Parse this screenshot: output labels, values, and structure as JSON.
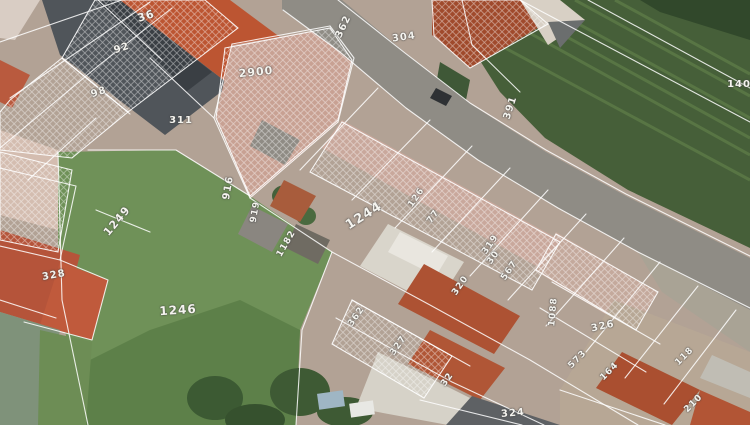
{
  "map": {
    "type": "cadastral-parcel-overlay-on-aerial-photo",
    "overlay_color": "#ffffff",
    "label_color": "#f5f4ef",
    "labels": [
      {
        "text": "36",
        "x": 146,
        "y": 16,
        "rot": -18,
        "size": 11
      },
      {
        "text": "92",
        "x": 122,
        "y": 49,
        "rot": -18,
        "size": 10
      },
      {
        "text": "98",
        "x": 99,
        "y": 93,
        "rot": -18,
        "size": 10
      },
      {
        "text": "311",
        "x": 181,
        "y": 121,
        "rot": 0,
        "size": 10
      },
      {
        "text": "2900",
        "x": 256,
        "y": 72,
        "rot": -6,
        "size": 11
      },
      {
        "text": "362",
        "x": 344,
        "y": 27,
        "rot": -65,
        "size": 10
      },
      {
        "text": "304",
        "x": 404,
        "y": 38,
        "rot": -8,
        "size": 10
      },
      {
        "text": "391",
        "x": 511,
        "y": 108,
        "rot": -72,
        "size": 10
      },
      {
        "text": "140",
        "x": 739,
        "y": 85,
        "rot": 0,
        "size": 10
      },
      {
        "text": "916",
        "x": 229,
        "y": 188,
        "rot": -80,
        "size": 10
      },
      {
        "text": "919",
        "x": 256,
        "y": 212,
        "rot": -80,
        "size": 9
      },
      {
        "text": "1182",
        "x": 287,
        "y": 244,
        "rot": -60,
        "size": 9
      },
      {
        "text": "1244",
        "x": 364,
        "y": 216,
        "rot": -32,
        "size": 13
      },
      {
        "text": "126",
        "x": 417,
        "y": 198,
        "rot": -55,
        "size": 9
      },
      {
        "text": "77",
        "x": 434,
        "y": 217,
        "rot": -55,
        "size": 9
      },
      {
        "text": "319",
        "x": 491,
        "y": 245,
        "rot": -55,
        "size": 9
      },
      {
        "text": "30",
        "x": 494,
        "y": 258,
        "rot": -55,
        "size": 9
      },
      {
        "text": "567",
        "x": 510,
        "y": 271,
        "rot": -55,
        "size": 9
      },
      {
        "text": "320",
        "x": 461,
        "y": 286,
        "rot": -55,
        "size": 9
      },
      {
        "text": "1249",
        "x": 117,
        "y": 221,
        "rot": -50,
        "size": 11
      },
      {
        "text": "328",
        "x": 54,
        "y": 276,
        "rot": -10,
        "size": 10
      },
      {
        "text": "1246",
        "x": 178,
        "y": 310,
        "rot": -4,
        "size": 12
      },
      {
        "text": "362",
        "x": 357,
        "y": 317,
        "rot": -55,
        "size": 9
      },
      {
        "text": "327",
        "x": 399,
        "y": 346,
        "rot": -55,
        "size": 9
      },
      {
        "text": "32",
        "x": 448,
        "y": 380,
        "rot": -55,
        "size": 9
      },
      {
        "text": "324",
        "x": 513,
        "y": 414,
        "rot": -5,
        "size": 10
      },
      {
        "text": "1088",
        "x": 554,
        "y": 312,
        "rot": -85,
        "size": 9
      },
      {
        "text": "326",
        "x": 603,
        "y": 327,
        "rot": -12,
        "size": 10
      },
      {
        "text": "573",
        "x": 578,
        "y": 360,
        "rot": -45,
        "size": 9
      },
      {
        "text": "164",
        "x": 610,
        "y": 372,
        "rot": -45,
        "size": 9
      },
      {
        "text": "118",
        "x": 685,
        "y": 357,
        "rot": -45,
        "size": 9
      },
      {
        "text": "210",
        "x": 694,
        "y": 404,
        "rot": -45,
        "size": 9
      }
    ],
    "overlay": {
      "lines": [
        [
          338,
          0,
          405,
          53,
          470,
          103,
          546,
          150,
          626,
          194,
          750,
          256
        ],
        [
          283,
          10,
          340,
          52,
          406,
          108,
          478,
          160,
          558,
          208,
          638,
          252,
          750,
          308
        ],
        [
          214,
          118,
          250,
          198,
          332,
          252,
          430,
          305,
          530,
          360,
          638,
          425
        ],
        [
          88,
          150,
          176,
          150,
          250,
          196
        ],
        [
          58,
          152,
          62,
          300,
          88,
          425
        ],
        [
          332,
          252,
          302,
          330,
          296,
          425
        ],
        [
          0,
          42,
          122,
          0
        ],
        [
          10,
          98,
          150,
          2
        ],
        [
          0,
          148,
          98,
          66,
          172,
          8
        ],
        [
          62,
          58,
          130,
          114
        ],
        [
          98,
          0,
          162,
          60
        ],
        [
          28,
          180,
          96,
          118
        ],
        [
          150,
          58,
          214,
          118
        ],
        [
          232,
          44,
          214,
          118
        ],
        [
          232,
          44,
          330,
          26
        ],
        [
          330,
          26,
          354,
          58,
          338,
          122
        ],
        [
          338,
          122,
          250,
          198
        ],
        [
          378,
          88,
          300,
          170
        ],
        [
          430,
          120,
          352,
          200
        ],
        [
          472,
          146,
          395,
          228
        ],
        [
          510,
          168,
          432,
          252
        ],
        [
          548,
          190,
          470,
          276
        ],
        [
          586,
          214,
          508,
          300
        ],
        [
          624,
          238,
          546,
          326
        ],
        [
          660,
          262,
          586,
          352
        ],
        [
          698,
          286,
          625,
          378
        ],
        [
          736,
          310,
          664,
          404
        ],
        [
          520,
          0,
          750,
          122
        ],
        [
          588,
          0,
          750,
          88
        ],
        [
          462,
          0,
          472,
          45,
          520,
          92
        ],
        [
          0,
          168,
          76,
          186,
          60,
          260,
          0,
          246
        ],
        [
          60,
          260,
          108,
          280,
          92,
          340,
          24,
          322
        ],
        [
          0,
          300,
          56,
          318
        ],
        [
          96,
          210,
          150,
          232
        ],
        [
          336,
          318,
          452,
          382,
          544,
          425
        ],
        [
          352,
          300,
          470,
          366
        ],
        [
          420,
          400,
          522,
          425
        ],
        [
          552,
          282,
          660,
          344
        ],
        [
          540,
          308,
          646,
          372
        ],
        [
          560,
          390,
          665,
          425
        ]
      ],
      "hatches": [
        [
          95,
          0,
          205,
          0,
          238,
          28,
          128,
          112,
          62,
          58
        ],
        [
          10,
          100,
          62,
          58,
          128,
          112,
          72,
          158,
          0,
          150,
          0,
          112
        ],
        [
          225,
          48,
          330,
          28,
          352,
          60,
          338,
          120,
          250,
          196,
          216,
          118
        ],
        [
          342,
          122,
          560,
          242,
          532,
          290,
          310,
          172
        ],
        [
          556,
          234,
          658,
          292,
          636,
          330,
          536,
          270
        ],
        [
          352,
          300,
          452,
          356,
          424,
          398,
          332,
          344
        ],
        [
          0,
          152,
          72,
          170,
          58,
          252,
          0,
          240
        ],
        [
          432,
          0,
          520,
          0,
          548,
          24,
          470,
          68,
          434,
          36
        ]
      ]
    }
  }
}
